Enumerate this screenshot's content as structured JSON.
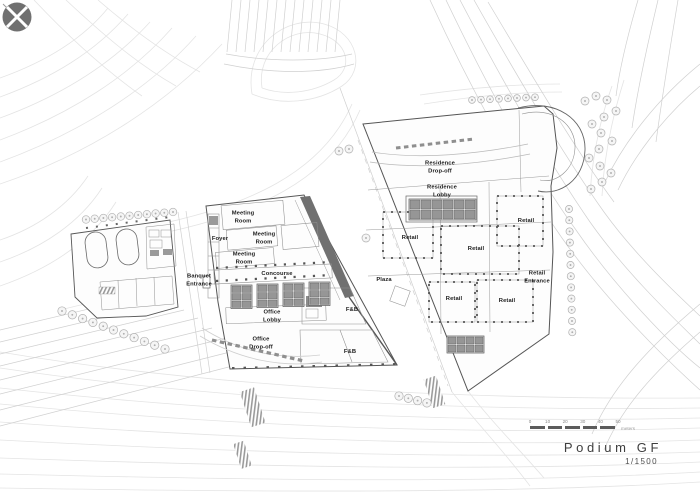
{
  "drawing": {
    "title": "Podium GF",
    "scale_text": "1/1500",
    "scale_bar": {
      "tick_labels": [
        "0",
        "10",
        "20",
        "30",
        "40",
        "50"
      ],
      "unit_label": "meters"
    },
    "north_symbol": "north-arrow"
  },
  "colors": {
    "background": "#ffffff",
    "line_faint": "#e4e4e4",
    "line_medium": "#d0d0d0",
    "line_dark": "#555555",
    "tower_band": "#707070",
    "compass_fill": "#707070",
    "label_text": "#1c1c1c"
  },
  "room_labels": [
    {
      "id": "meeting-room-1",
      "text": "Meeting\nRoom",
      "x": 243,
      "y": 218
    },
    {
      "id": "meeting-room-2",
      "text": "Meeting\nRoom",
      "x": 264,
      "y": 239
    },
    {
      "id": "foyer",
      "text": "Foyer",
      "x": 220,
      "y": 240
    },
    {
      "id": "meeting-room-3",
      "text": "Meeting\nRoom",
      "x": 244,
      "y": 259
    },
    {
      "id": "concourse",
      "text": "Concourse",
      "x": 277,
      "y": 275
    },
    {
      "id": "banquet-entrance",
      "text": "Banquet\nEntrance",
      "x": 199,
      "y": 281
    },
    {
      "id": "office-lobby",
      "text": "Office\nLobby",
      "x": 272,
      "y": 317
    },
    {
      "id": "office-drop-off",
      "text": "Office\nDrop-off",
      "x": 261,
      "y": 344
    },
    {
      "id": "fnb-upper",
      "text": "F&B",
      "x": 352,
      "y": 311
    },
    {
      "id": "fnb-lower",
      "text": "F&B",
      "x": 350,
      "y": 353
    },
    {
      "id": "plaza",
      "text": "Plaza",
      "x": 384,
      "y": 281
    },
    {
      "id": "residence-drop-off",
      "text": "Residence\nDrop-off",
      "x": 440,
      "y": 168
    },
    {
      "id": "residence-lobby",
      "text": "Residence\nLobby",
      "x": 442,
      "y": 192
    },
    {
      "id": "retail-west",
      "text": "Retail",
      "x": 410,
      "y": 239
    },
    {
      "id": "retail-center",
      "text": "Retail",
      "x": 476,
      "y": 250
    },
    {
      "id": "retail-east",
      "text": "Retail",
      "x": 526,
      "y": 222
    },
    {
      "id": "retail-south-west",
      "text": "Retail",
      "x": 454,
      "y": 300
    },
    {
      "id": "retail-south-east",
      "text": "Retail",
      "x": 507,
      "y": 302
    },
    {
      "id": "retail-entrance",
      "text": "Retail\nEntrance",
      "x": 537,
      "y": 278
    }
  ]
}
